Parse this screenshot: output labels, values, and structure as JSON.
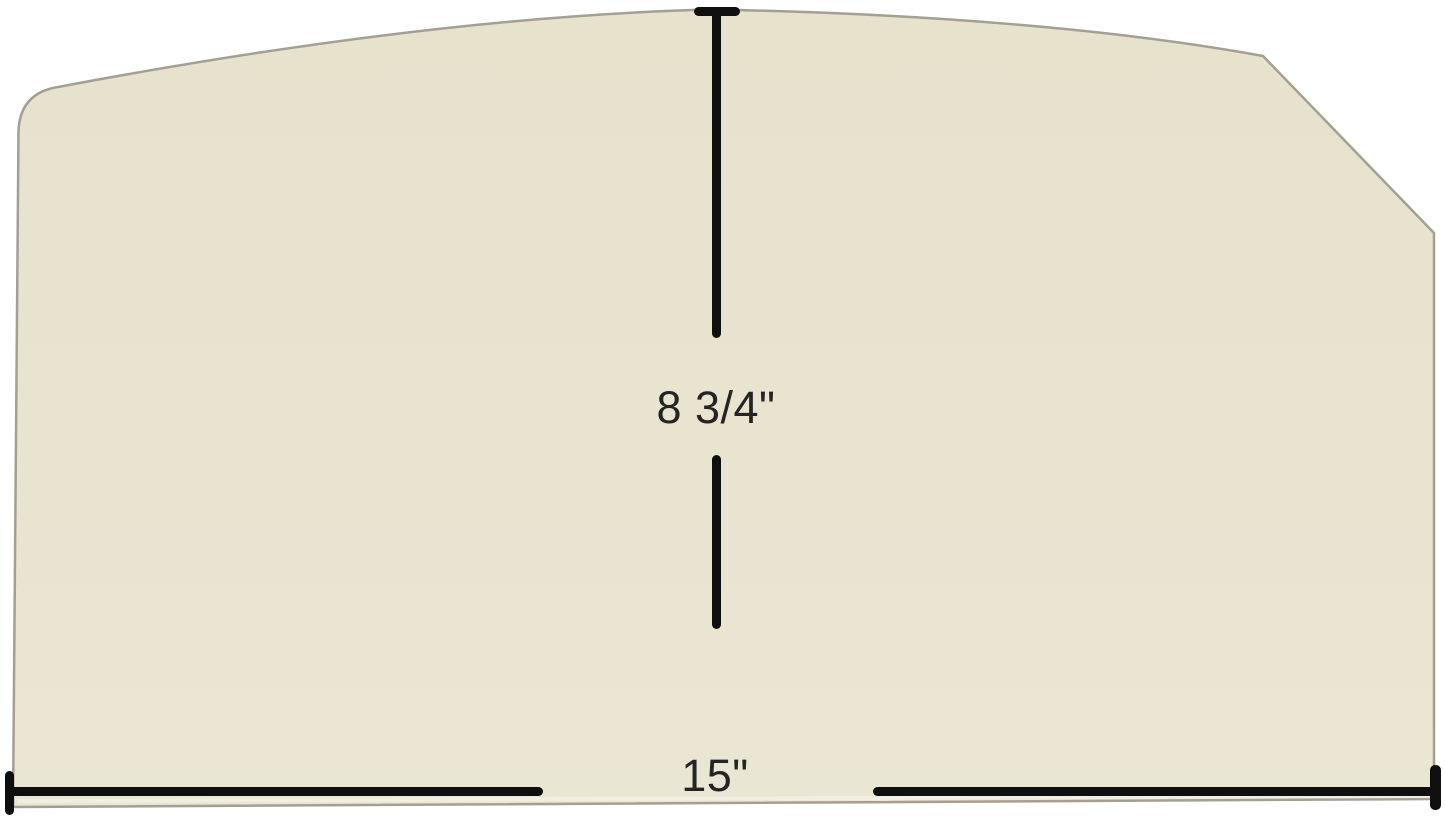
{
  "image": {
    "dimensions": {
      "height_label": "8 3/4\"",
      "width_label": "15\""
    },
    "colors": {
      "background": "#ffffff",
      "panel_fill": "#e8e4d0",
      "panel_edge": "#a59f92",
      "dimension_line": "#0f0f0f",
      "label_text": "#242424"
    }
  }
}
